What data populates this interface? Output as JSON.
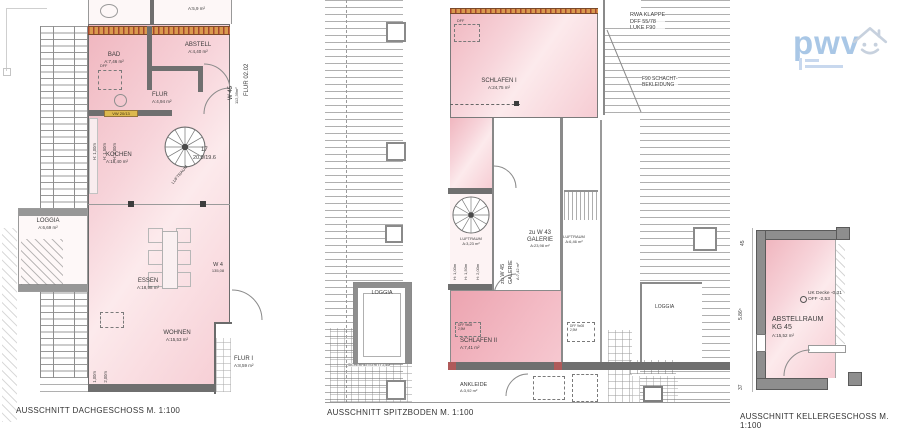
{
  "logo": {
    "text": "pwv"
  },
  "dach": {
    "caption": "AUSSCHNITT DACHGESCHOSS M. 1:100",
    "top_area": "A:5,9 m²",
    "bad_name": "BAD",
    "bad_area": "A:7,46 m²",
    "abstell_name": "ABSTELL",
    "abstell_area": "A:4,40 m²",
    "flur_name": "FLUR",
    "flur_area": "A:4,94 m²",
    "kochen_name": "KOCHEN",
    "kochen_area": "A:18,40 m²",
    "loggia_name": "LOGGIA",
    "loggia_area": "A:6,69 m²",
    "essen_name": "ESSEN",
    "essen_area": "A:18,98 m²",
    "wohnen_name": "WOHNEN",
    "wohnen_area": "A:15,53 m²",
    "flur1_name": "FLUR I",
    "flur1_area": "A:8,59 m²",
    "dff": "DFF",
    "stair_no": "17",
    "stair_dim": "20.0/19.6",
    "luftraum": "LUFTRAUM",
    "vw_badge": "VW 20/13",
    "w45": "W 45",
    "w45_area": "112,39m²",
    "flur_corridor": "FLUR 02.02",
    "w4": "W 4",
    "w4_area": "135,08",
    "h100": "H: 1,00m",
    "h150": "H: 1,50m",
    "h200": "H: 2,00m"
  },
  "spitz": {
    "caption": "AUSSCHNITT SPITZBODEN M. 1:100",
    "schlafen1_name": "SCHLAFEN I",
    "schlafen1_area": "A:24,75 m²",
    "schlafen2_name": "SCHLAFEN II",
    "schlafen2_area": "A:7,41 m²",
    "ankleide_name": "ANKLEIDE",
    "ankleide_area": "A:3,92 m²",
    "loggia_name": "LOGGIA",
    "loggia_right": "LOGGIA",
    "dff": "DFF",
    "luftraum1": "LUFTRAUM",
    "luftraum1_area": "A:3,23 m²",
    "luftraum2": "LUFTRAUM",
    "luftraum2_area": "A:6,46 m²",
    "gal45_l1": "zu W 45",
    "gal45_l2": "GALERIE",
    "gal45_area": "A:7,42 m²",
    "gal43_l1": "zu W 43",
    "gal43_l2": "GALERIE",
    "gal43_area": "A:23,98 m²",
    "h100": "H: 1,00m",
    "h150": "H: 1,50m",
    "h200": "H: 2,00m",
    "dff_box_l1": "DFF 9x08",
    "dff_box_l2": "2,9M",
    "rwa_l1": "RWA KLAPPE",
    "rwa_l2": "DFF 55/78",
    "rwa_l3": "LUKE F90",
    "f90_l1": "F90 SCHACHT-",
    "f90_l2": "BEKLEIDUNG",
    "tritt": "SICHERHEITSTRITT 2,5M"
  },
  "keller": {
    "caption": "AUSSCHNITT KELLERGESCHOSS M. 1:100",
    "room_name": "ABSTELLRAUM",
    "room_no": "KG 45",
    "room_area": "A:15,52 m²",
    "uk": "UK Decke -0,31",
    "off": "OFF -2,53",
    "dim_top": "45",
    "dim_mid": "5.86⁵",
    "dim_bot": "37"
  }
}
